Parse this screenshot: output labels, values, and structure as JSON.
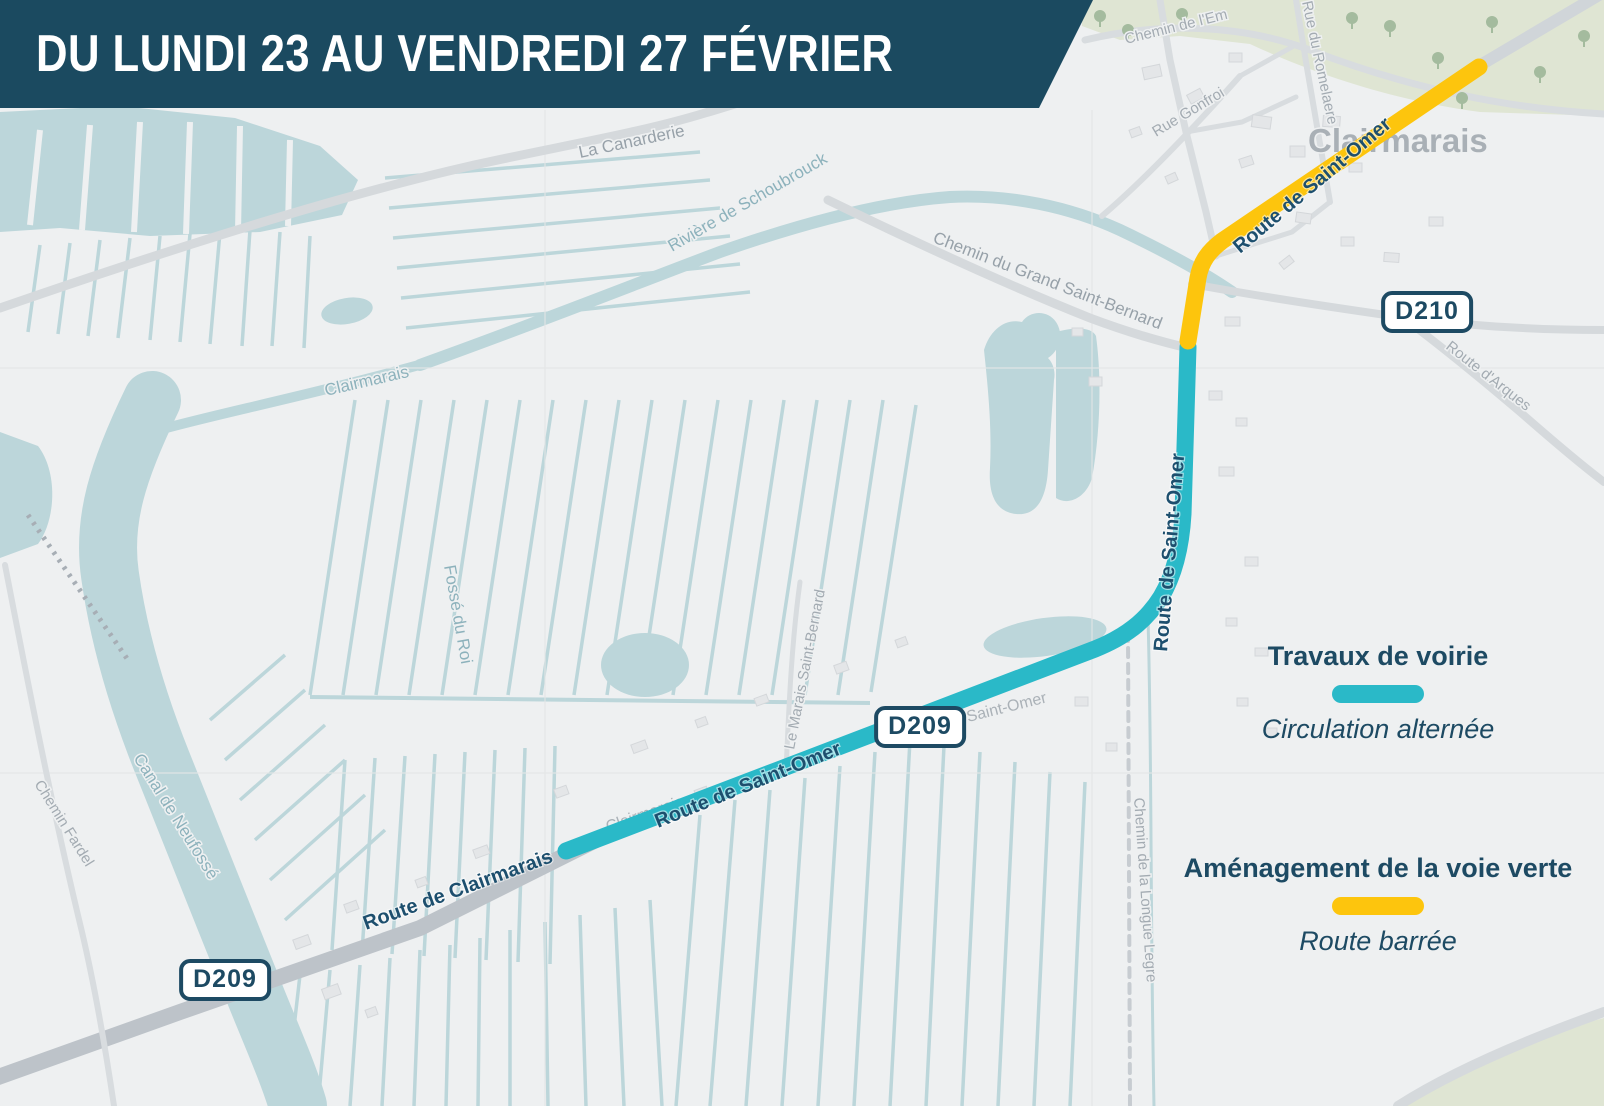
{
  "banner": {
    "title": "DU LUNDI 23 AU VENDREDI 27 FÉVRIER"
  },
  "legend": {
    "roadworks_title": "Travaux de voirie",
    "roadworks_subtitle": "Circulation alternée",
    "greenway_title": "Aménagement de la voie verte",
    "greenway_subtitle": "Route barrée"
  },
  "badges": {
    "d209_west": "D209",
    "d209_mid": "D209",
    "d210": "D210"
  },
  "map_labels": {
    "la_canarderie": "La Canarderie",
    "riviere_schoubrouck": "Rivière de Schoubrouck",
    "chemin_grand_st_bernard": "Chemin du Grand Saint-Bernard",
    "chemin_de_l_e": "Chemin de l'Em",
    "rue_gonfroi": "Rue Gonfroi",
    "rue_du_romelaere": "Rue du Romelaere",
    "town": "Clairmarais",
    "route_d_arques": "Route d'Arques",
    "clairmarais_channel": "Clairmarais",
    "fosse_du_roi": "Fossé du Roi",
    "canal_de_neufosse": "Canal de Neufossé",
    "chemin_fardel": "Chemin Fardel",
    "route_de_clairmarais": "Route de Clairmarais",
    "clairmarais_faint": "Clairmarais",
    "saint_omer_faint": "Saint-Omer",
    "le_marais_st_bernard": "Le Marais Saint-Bernard",
    "chemin_longue_legre": "Chemin de la Longue Legre",
    "route_st_omer_diag": "Route de Saint-Omer",
    "route_st_omer_vert": "Route de Saint-Omer",
    "route_st_omer_yellow": "Route de Saint-Omer"
  },
  "colors": {
    "banner_bg": "#1b4a60",
    "navy": "#1d4a63",
    "teal": "#2ab9c8",
    "yellow": "#fdc50d",
    "water": "#bcd6da",
    "map_bg": "#eef0f1",
    "park": "#dfe5d3",
    "road_gray": "#d5d9dc"
  }
}
